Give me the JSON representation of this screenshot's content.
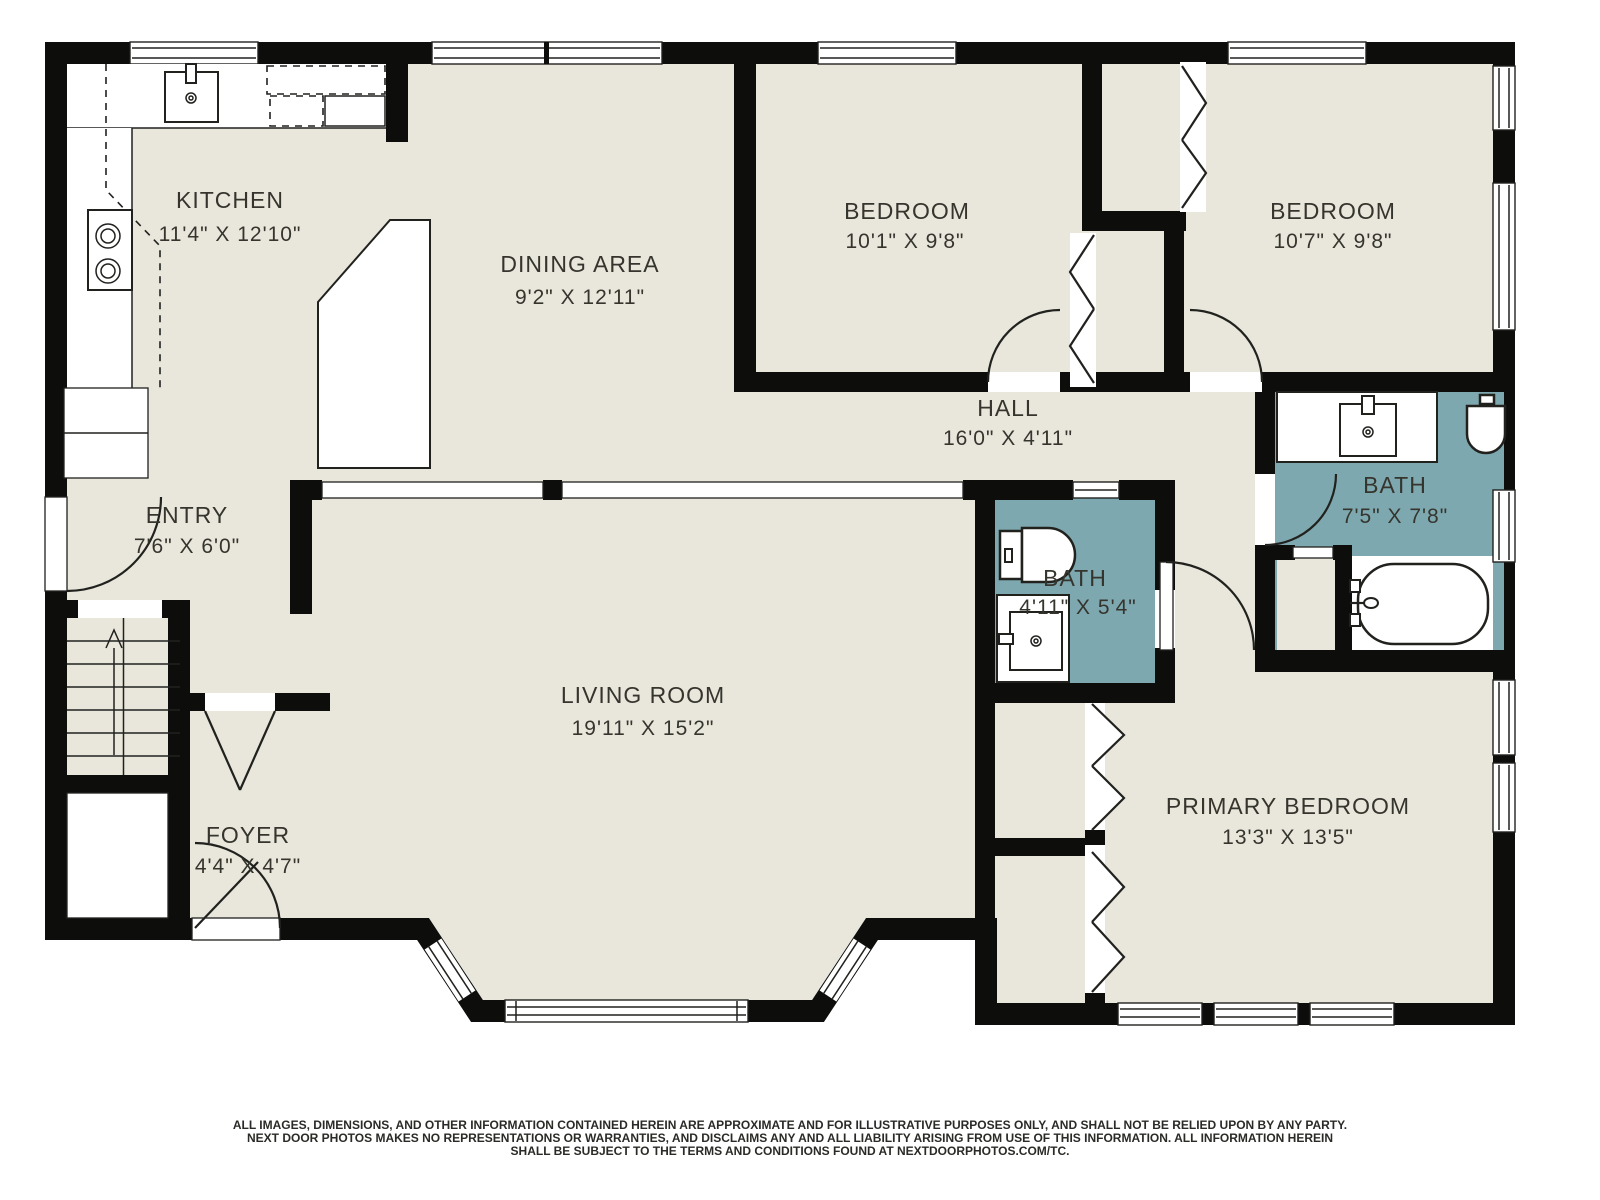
{
  "floorplan": {
    "title": "Main floor plan",
    "colors": {
      "floor": "#e9e7dc",
      "wall": "#0d0d0c",
      "bath_fill": "#7ea8af",
      "line": "#21211e",
      "text": "#35352e"
    },
    "rooms": {
      "kitchen": {
        "name": "KITCHEN",
        "dims": "11'4\" X 12'10\""
      },
      "dining": {
        "name": "DINING AREA",
        "dims": "9'2\" X 12'11\""
      },
      "bedroom1": {
        "name": "BEDROOM",
        "dims": "10'1\" X 9'8\""
      },
      "bedroom2": {
        "name": "BEDROOM",
        "dims": "10'7\" X 9'8\""
      },
      "hall": {
        "name": "HALL",
        "dims": "16'0\" X 4'11\""
      },
      "bath_upper": {
        "name": "BATH",
        "dims": "7'5\" X 7'8\""
      },
      "entry": {
        "name": "ENTRY",
        "dims": "7'6\" X 6'0\""
      },
      "bath_lower": {
        "name": "BATH",
        "dims": "4'11\" X 5'4\""
      },
      "living": {
        "name": "LIVING ROOM",
        "dims": "19'11\" X 15'2\""
      },
      "foyer": {
        "name": "FOYER",
        "dims": "4'4\" X 4'7\""
      },
      "primary": {
        "name": "PRIMARY BEDROOM",
        "dims": "13'3\" X 13'5\""
      }
    }
  },
  "disclaimer": {
    "line1": "ALL IMAGES, DIMENSIONS, AND OTHER INFORMATION CONTAINED HEREIN ARE APPROXIMATE AND FOR ILLUSTRATIVE PURPOSES ONLY, AND SHALL NOT BE RELIED UPON BY ANY PARTY.",
    "line2": "NEXT DOOR PHOTOS MAKES NO REPRESENTATIONS OR WARRANTIES, AND DISCLAIMS ANY AND ALL LIABILITY ARISING FROM USE OF THIS INFORMATION. ALL INFORMATION HEREIN",
    "line3": "SHALL BE SUBJECT TO THE TERMS AND CONDITIONS FOUND AT NEXTDOORPHOTOS.COM/TC."
  }
}
